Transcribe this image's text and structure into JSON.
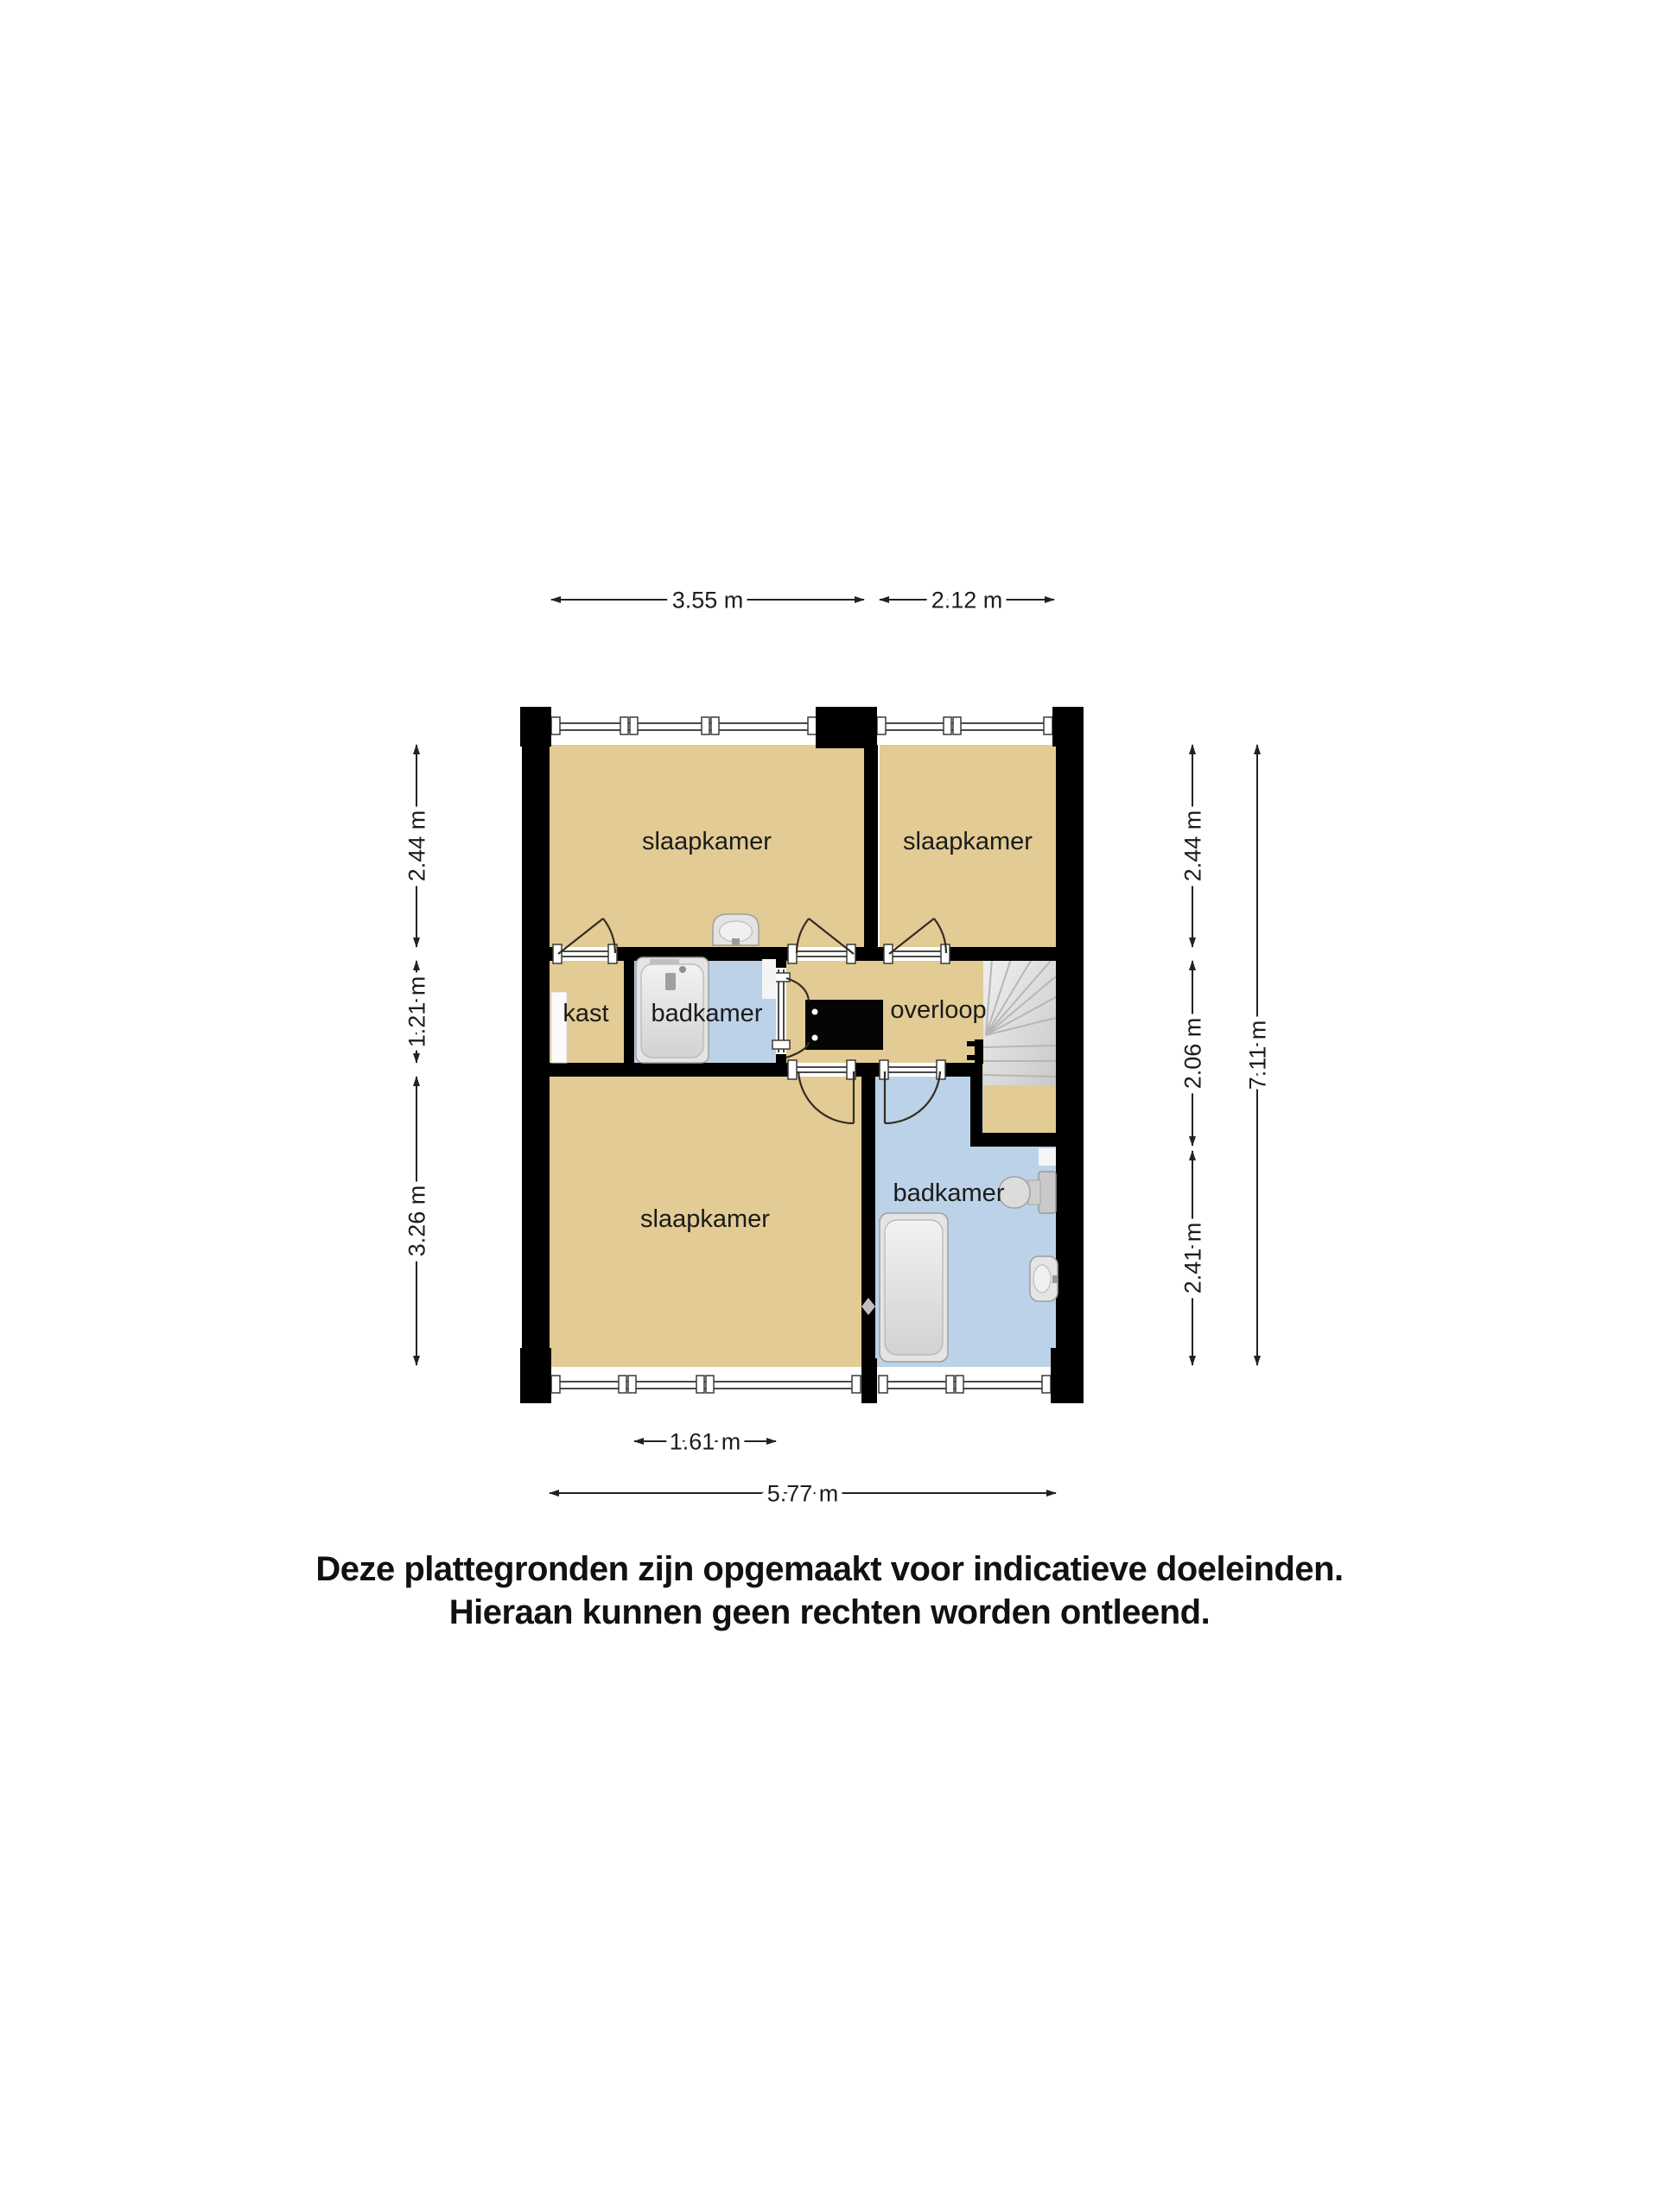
{
  "floorplan": {
    "rooms": {
      "bedroom_top_left": "slaapkamer",
      "bedroom_top_right": "slaapkamer",
      "bedroom_bottom": "slaapkamer",
      "closet": "kast",
      "bathroom_middle": "badkamer",
      "bathroom_bottom": "badkamer",
      "landing": "overloop"
    },
    "dimensions": {
      "top_left": "3.55 m",
      "top_right": "2.12 m",
      "left_top": "2.44 m",
      "left_middle": "1.21 m",
      "left_bottom": "3.26 m",
      "right_top": "2.44 m",
      "right_middle": "2.06 m",
      "right_bottom": "2.41 m",
      "right_total": "7.11 m",
      "bottom_inner": "1.61 m",
      "bottom_total": "5.77 m"
    },
    "colors": {
      "floor": "#e2cb94",
      "bathroom_floor": "#bcd2e8",
      "wall": "#000000",
      "stairs_light": "#ececec",
      "stairs_dark": "#cfcfcf"
    }
  },
  "disclaimer": {
    "line1": "Deze plattegronden zijn opgemaakt voor indicatieve doeleinden.",
    "line2": "Hieraan kunnen geen rechten worden ontleend."
  }
}
